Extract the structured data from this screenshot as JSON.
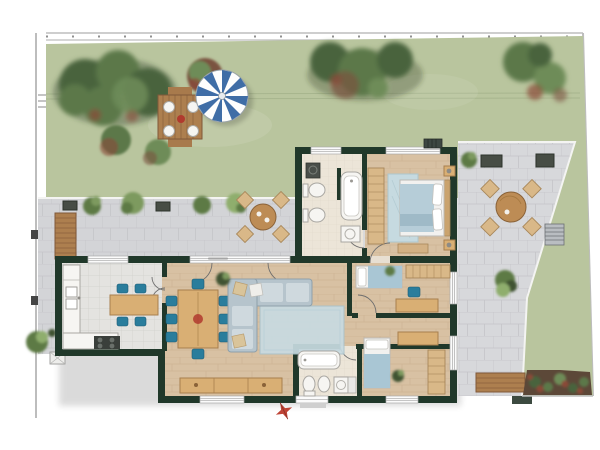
{
  "colors": {
    "lawn": "#b9c59e",
    "lawn_line": "#9aa981",
    "paver": "#d3d4d7",
    "paver2": "#d7d8db",
    "paver_joint": "#c2c3c7",
    "wall": "#20382a",
    "wood": "#d8c1a3",
    "wood_line": "#c3a784",
    "tile": "#e4e3e0",
    "tile_line": "#d0cfcb",
    "bath": "#ece5d8",
    "bath_tile": "#d8cfc2",
    "fixture": "#f6f5f2",
    "fixture_line": "#a9a7a2",
    "chair_teal": "#2a7d9c",
    "table_wood": "#d9af74",
    "table_wood_dark": "#a87f4e",
    "sofa": "#b6c4cc",
    "sofa_line": "#8fa0aa",
    "cushion": "#cfd9de",
    "rug": "#c8dbe1",
    "rug_master": "#c6dae0",
    "blanket": "#a9c6d4",
    "blanket_master": "#b6cdd8",
    "sheet": "#f2f1ef",
    "wardrobe": "#d9b888",
    "wardrobe_line": "#a8875a",
    "deck": "#ad7f4f",
    "deck_line": "#80583a",
    "bush1": "#5d7a45",
    "bush2": "#7d9a5f",
    "bush3": "#8fae6d",
    "bush_dark": "#3f5233",
    "tree1": "#49633c",
    "tree2": "#5b784a",
    "tree3": "#6e8c58",
    "red_bush": "#8a4a38",
    "brown_bush": "#7a5340",
    "flowerbed": "#5c4838",
    "umbrella": "#3f6da6",
    "boundary": "#bdbdbd",
    "skylight": "#474d45",
    "grate": "#b9bdc1",
    "north_arrow": "#bf4436",
    "step": "#cfcfcf"
  },
  "areas": {
    "garden": {
      "features": [
        "lawn",
        "hedge-cluster",
        "flower-bushes",
        "trees",
        "garden-dining-table",
        "parasol"
      ]
    },
    "left_patio": {
      "features": [
        "pavers",
        "wood-deck",
        "skylights",
        "shrubs",
        "bistro-table-set",
        "manhole"
      ]
    },
    "right_patio": {
      "features": [
        "pavers",
        "skylights",
        "outdoor-table-set",
        "grate",
        "shrubs",
        "garden-bench",
        "flower-bed"
      ]
    }
  },
  "rooms": [
    {
      "name": "bathroom-1",
      "furniture": [
        "washing-machine",
        "toilet",
        "bidet",
        "bathtub",
        "sink"
      ]
    },
    {
      "name": "master-bedroom",
      "furniture": [
        "wardrobe",
        "rug",
        "double-bed",
        "nightstands",
        "foot-bench"
      ]
    },
    {
      "name": "kitchen",
      "furniture": [
        "counter",
        "sink",
        "cooktop",
        "table",
        "chairs"
      ]
    },
    {
      "name": "living-dining-room",
      "furniture": [
        "dining-table",
        "chairs",
        "corner-sofa",
        "rug",
        "plant",
        "sideboard"
      ]
    },
    {
      "name": "bedroom-2",
      "furniture": [
        "single-bed",
        "wardrobe",
        "desk",
        "chair",
        "plant"
      ]
    },
    {
      "name": "bedroom-3",
      "furniture": [
        "single-bed",
        "wardrobe",
        "desk",
        "plant"
      ]
    },
    {
      "name": "bathroom-2",
      "furniture": [
        "bathtub",
        "toilet",
        "bidet",
        "sink",
        "washing-machine"
      ]
    }
  ],
  "compass": {
    "type": "north-arrow"
  }
}
